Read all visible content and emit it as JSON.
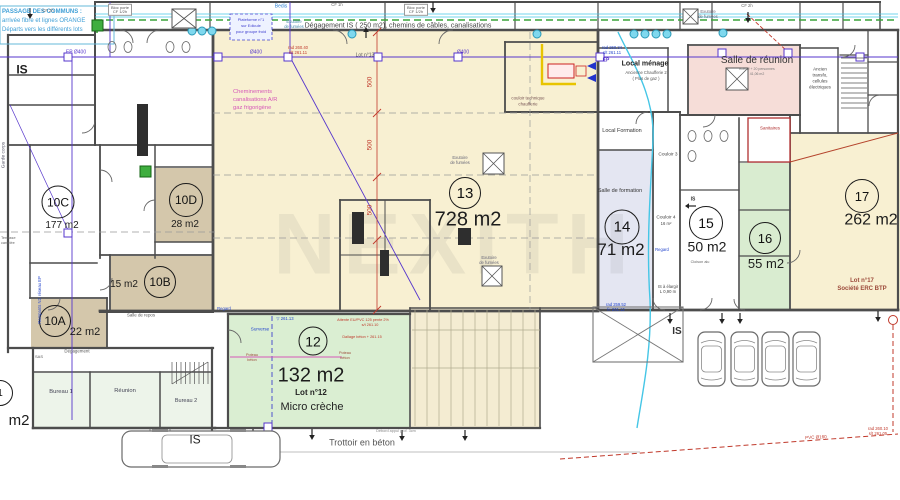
{
  "passage": {
    "l1": "PASSAGE DES COMMUNS :",
    "l2": "arrivée fibre et lignes ORANGE",
    "l3": "Départs vers les différents lots"
  },
  "corridor": {
    "label": "Dégagement IS ( 250 m2), chemins de câbles, canalisations",
    "bloc_porte": "Bloc porte",
    "cf_half": "CF 1/2h",
    "cf_1h": "CF 1h",
    "cf_2h": "CF 2h",
    "bedis": "Bedis",
    "plateforme_l1": "Plateforme n°1",
    "plateforme_l2": "sur Edicule",
    "plateforme_l3": "pour groupe froid",
    "exutoire_l1": "Exutoire",
    "exutoire_l2": "de fumées"
  },
  "rooms": {
    "r10a": {
      "num": "10A",
      "area": "22 m2"
    },
    "r10b": {
      "num": "10B",
      "area": "15 m2"
    },
    "r10c": {
      "num": "10C",
      "area": "177 m2"
    },
    "r10d": {
      "num": "10D",
      "area": "28 m2"
    },
    "r12": {
      "num": "12",
      "area": "132 m2",
      "lot": "Lot n°12",
      "name": "Micro crèche"
    },
    "r13": {
      "num": "13",
      "area": "728 m2",
      "lot": "Lot n°13"
    },
    "r14": {
      "num": "14",
      "area": "71 m2"
    },
    "r15": {
      "num": "15",
      "area": "50 m2"
    },
    "r16": {
      "num": "16",
      "area": "55 m2"
    },
    "r17": {
      "num": "17",
      "area": "262 m2",
      "lot": "Lot n°17",
      "company": "Société ERC BTP"
    },
    "partial": {
      "num": "1",
      "area": "m2"
    }
  },
  "areas": {
    "salle_reunion": "Salle de réunion",
    "reunion_sub1": "effectif + 20 personnes",
    "reunion_sub2": "41,06 m2",
    "local_menage": "Local ménage",
    "chaufferie_l1": "Ancienne Chaufferie 2",
    "chaufferie_l2": "( Plus de gaz )",
    "couloir_tech_l1": "couloir technique",
    "couloir_tech_l2": "chaufferie",
    "local_formation": "Local Formation",
    "salle_formation": "Salle de formation",
    "transfo_l1": "Ancien",
    "transfo_l2": "transfo,",
    "transfo_l3": "cellules",
    "transfo_l4": "électriques",
    "sanitaires": "Sanitaires",
    "couloir3": "Couloir 3",
    "couloir4": "Couloir 4",
    "couloir4_area": "16 m²",
    "cloison_alu": "Cloison alu",
    "bureau1": "Bureau 1",
    "reunion": "Réunion",
    "bureau2": "Bureau 2",
    "salle_repos": "Salle de repos",
    "degagement": "Dégagement",
    "sas": "SAS"
  },
  "annotations": {
    "cheminements_l1": "Cheminements",
    "cheminements_l2": "canalisations A/R",
    "cheminements_l3": "gaz frigorigène",
    "is": "IS",
    "is_elargir_l1": "IS à élargir",
    "is_elargir_l2": "L 0,90 m",
    "garde_corps": "Garde corps",
    "rampants": "Rampants N2, réseau EP",
    "terrasse_l1": "Terrasse",
    "terrasse_l2": "carrelée",
    "surverse": "Surverse",
    "regard": "Regard",
    "poteau_l1": "Poteau",
    "poteau_l2": "béton",
    "attente": "Attente EU/PVC 125 pente 2%",
    "attente2": "s/t 261.10",
    "dallage": "Dallage béton + 261.15",
    "level": "▽ 261.13",
    "trottoir": "Trottoir en béton",
    "debord": "Débord appui prof. 3cm"
  },
  "pipes": {
    "ep_d400": "EP Ø400",
    "d400": "Ø400",
    "ep": "EP",
    "pvc160": "PVC Ø160",
    "dim_500": "500",
    "rad_a1": "rad 260.40",
    "rad_a2": "s/t 261.11",
    "rad_b1": "rad 260.34",
    "rad_b2": "s/t 261.11",
    "rad_c1": "rad 259.52",
    "rad_c2": "fe 261.12",
    "rad_d1": "rad 260.10",
    "rad_d2": "s/t 261.05"
  },
  "watermark": "NEXITH",
  "colors": {
    "cream": "#f8f0d2",
    "green": "#daeed2",
    "tan": "#d4c7ab",
    "lavender": "#e4e6f2",
    "pink": "#f6ddd8",
    "office": "#edf4ea",
    "wall": "#4d4d4d",
    "pipe_purple": "#5636cc",
    "pipe_cyan": "#45c6e6",
    "dash_green": "#3aa33a",
    "dim_red": "#c0392b",
    "note_blue": "#2a7fd0",
    "magenta": "#d558b8",
    "maroon": "#9c4a3a"
  }
}
